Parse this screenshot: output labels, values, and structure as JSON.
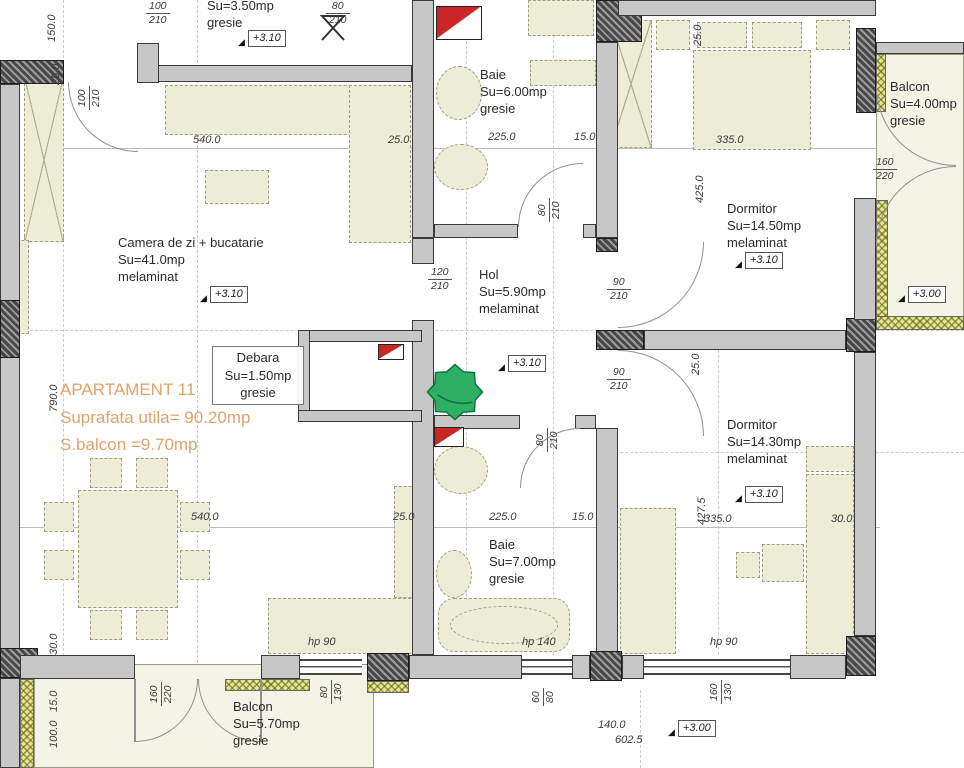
{
  "apartment": {
    "title": "APARTAMENT 11",
    "usable_area": "Suprafata utila= 90.20mp",
    "balcony_area": "S.balcon =9.70mp"
  },
  "rooms": {
    "top_room": {
      "area": "Su=3.50mp",
      "finish": "gresie"
    },
    "living": {
      "name": "Camera de zi + bucatarie",
      "area": "Su=41.0mp",
      "finish": "melaminat"
    },
    "baie_top": {
      "name": "Baie",
      "area": "Su=6.00mp",
      "finish": "gresie"
    },
    "hol": {
      "name": "Hol",
      "area": "Su=5.90mp",
      "finish": "melaminat"
    },
    "dormitor_top": {
      "name": "Dormitor",
      "area": "Su=14.50mp",
      "finish": "melaminat"
    },
    "balcon_right": {
      "name": "Balcon",
      "area": "Su=4.00mp",
      "finish": "gresie"
    },
    "dormitor_bottom": {
      "name": "Dormitor",
      "area": "Su=14.30mp",
      "finish": "melaminat"
    },
    "baie_bottom": {
      "name": "Baie",
      "area": "Su=7.00mp",
      "finish": "gresie"
    },
    "debara": {
      "name": "Debara",
      "area": "Su=1.50mp",
      "finish": "gresie"
    },
    "balcon_bottom": {
      "name": "Balcon",
      "area": "Su=5.70mp",
      "finish": "gresie"
    }
  },
  "levels": {
    "floor": "+3.10",
    "balcony": "+3.00"
  },
  "dims": {
    "h540": "540.0",
    "h25": "25.0",
    "h225": "225.0",
    "h15": "15.0",
    "h335": "335.0",
    "h30": "30.0",
    "v150": "150.0",
    "v25": "25.0",
    "v790": "790.0",
    "v30": "30.0",
    "v15": "15.0",
    "v100": "100.0",
    "v425": "425.0",
    "v427_5": "427.5",
    "b140": "140.0",
    "b602_5": "602.5"
  },
  "openings": {
    "door_100_210": {
      "w": "100",
      "h": "210"
    },
    "door_80_210": {
      "w": "80",
      "h": "210"
    },
    "door_120_210": {
      "w": "120",
      "h": "210"
    },
    "door_90_210": {
      "w": "90",
      "h": "210"
    },
    "door_160_220": {
      "w": "160",
      "h": "220"
    },
    "win_80_130": {
      "w": "80",
      "h": "130"
    },
    "win_60_80": {
      "w": "60",
      "h": "80"
    },
    "win_160_130": {
      "w": "160",
      "h": "130"
    },
    "hp90": "hp 90",
    "hp140": "hp 140"
  },
  "colors": {
    "accent_orange": "#e2a369",
    "tree_green": "#2fae66",
    "shaft_red": "#c92727",
    "balcony_hatch": "#e3e496"
  }
}
